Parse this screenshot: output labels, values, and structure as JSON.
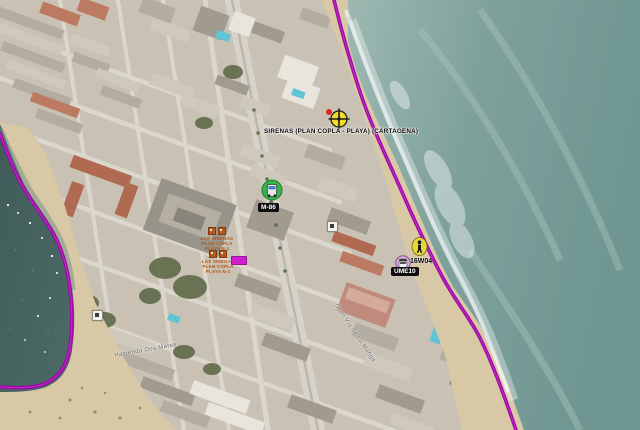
{
  "map": {
    "type": "satellite",
    "boundary_color": "#a008a8",
    "markers": {
      "siren": {
        "icon": "siren-crosshair-icon",
        "label": "SIRENAS (PLAN COPLA - PLAYA) (CARTAGENA)"
      },
      "m86": {
        "icon": "green-vehicle-icon",
        "label": "M-86"
      },
      "person": {
        "icon": "person-icon"
      },
      "unit16w04": {
        "icon": "van-icon",
        "label": "16W04"
      },
      "ume10": {
        "icon": "black-tag",
        "label": "UME10"
      }
    },
    "street_labels": {
      "main_road": "Gran Vía de La Manga",
      "left_street": "Hacienda Dos Mares"
    },
    "poi_orange": {
      "block1": {
        "lines": [
          "LAS SIRENAS",
          "PLAN COPLA",
          "PLAYA N-1"
        ]
      },
      "block2": {
        "lines": [
          "LAS SIRENAS",
          "PLAN COPLA",
          "PLAYA N-2"
        ]
      }
    }
  }
}
